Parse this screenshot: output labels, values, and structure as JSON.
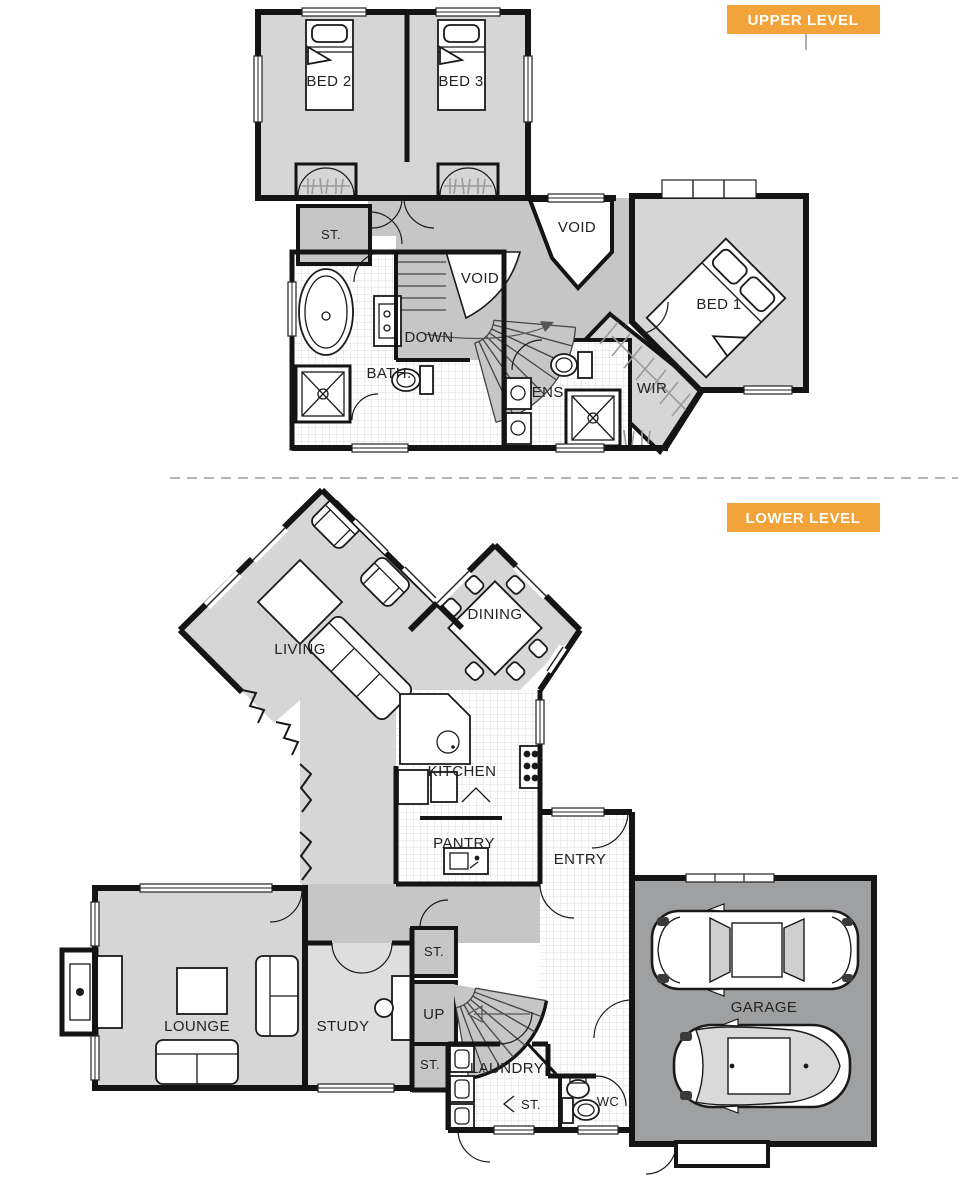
{
  "palette": {
    "accent_orange": "#F2A33A",
    "wall_black": "#141414",
    "room_gray": "#d6d6d6",
    "hall_gray": "#c6c6c6",
    "garage_gray": "#9fa0a2",
    "tile_line": "#dcdcdc",
    "label_color": "#222222",
    "divider_dash": "#b5b5b5"
  },
  "upper_level": {
    "badge": "UPPER LEVEL",
    "labels": {
      "bed2": "BED 2",
      "bed3": "BED 3",
      "store": "ST.",
      "void_a": "VOID",
      "void_b": "VOID",
      "down": "DOWN",
      "bath": "BATH.",
      "ens": "ENS.",
      "wir": "WIR",
      "bed1": "BED 1"
    }
  },
  "lower_level": {
    "badge": "LOWER LEVEL",
    "labels": {
      "living": "LIVING",
      "dining": "DINING",
      "kitchen": "KITCHEN",
      "pantry": "PANTRY",
      "entry": "ENTRY",
      "lounge": "LOUNGE",
      "study": "STUDY",
      "store_hall": "ST.",
      "up": "UP",
      "store_study": "ST.",
      "laundry": "LAUNDRY",
      "store_laundry": "ST.",
      "wc": "WC",
      "garage": "GARAGE"
    }
  }
}
